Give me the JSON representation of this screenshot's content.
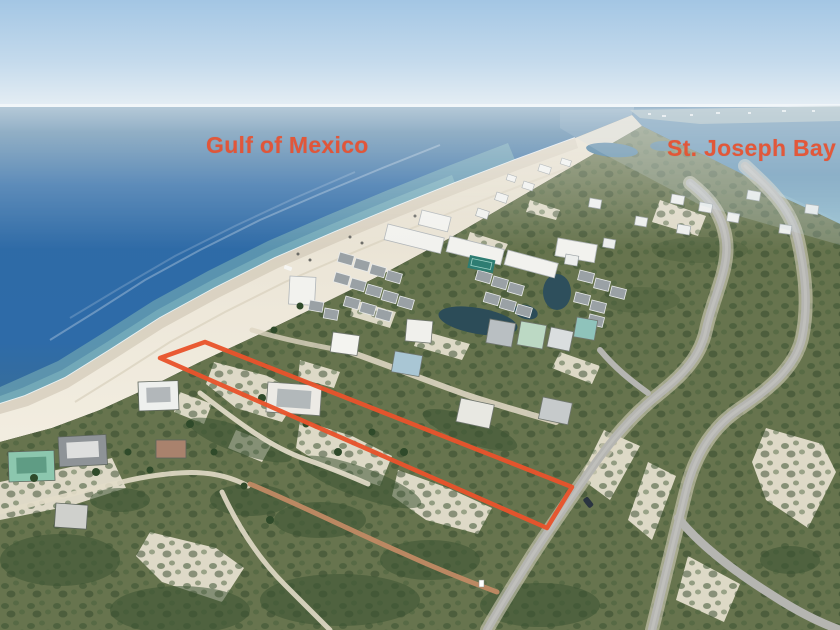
{
  "annotation": {
    "labels": {
      "gulf": "Gulf of Mexico",
      "bay": "St. Joseph Bay"
    },
    "label_color": "#e8512f",
    "outline_color": "#e8532c",
    "property_outline_points": "205,342 572,487 547,528 160,358"
  },
  "scene_colors": {
    "sky": "#bcd6ea",
    "gulf_water": "#2e6ba8",
    "shallow_water": "#6da4b2",
    "bay_water": "#4a80a8",
    "beach_sand": "#eee8da",
    "dune_sand": "#e8e2d1",
    "scrub_green": "#67744e",
    "dark_vegetation": "#3d5533",
    "road_asphalt": "#b5b5b1",
    "dirt_trail": "#c18a64",
    "pond_water": "#2c4c58"
  }
}
